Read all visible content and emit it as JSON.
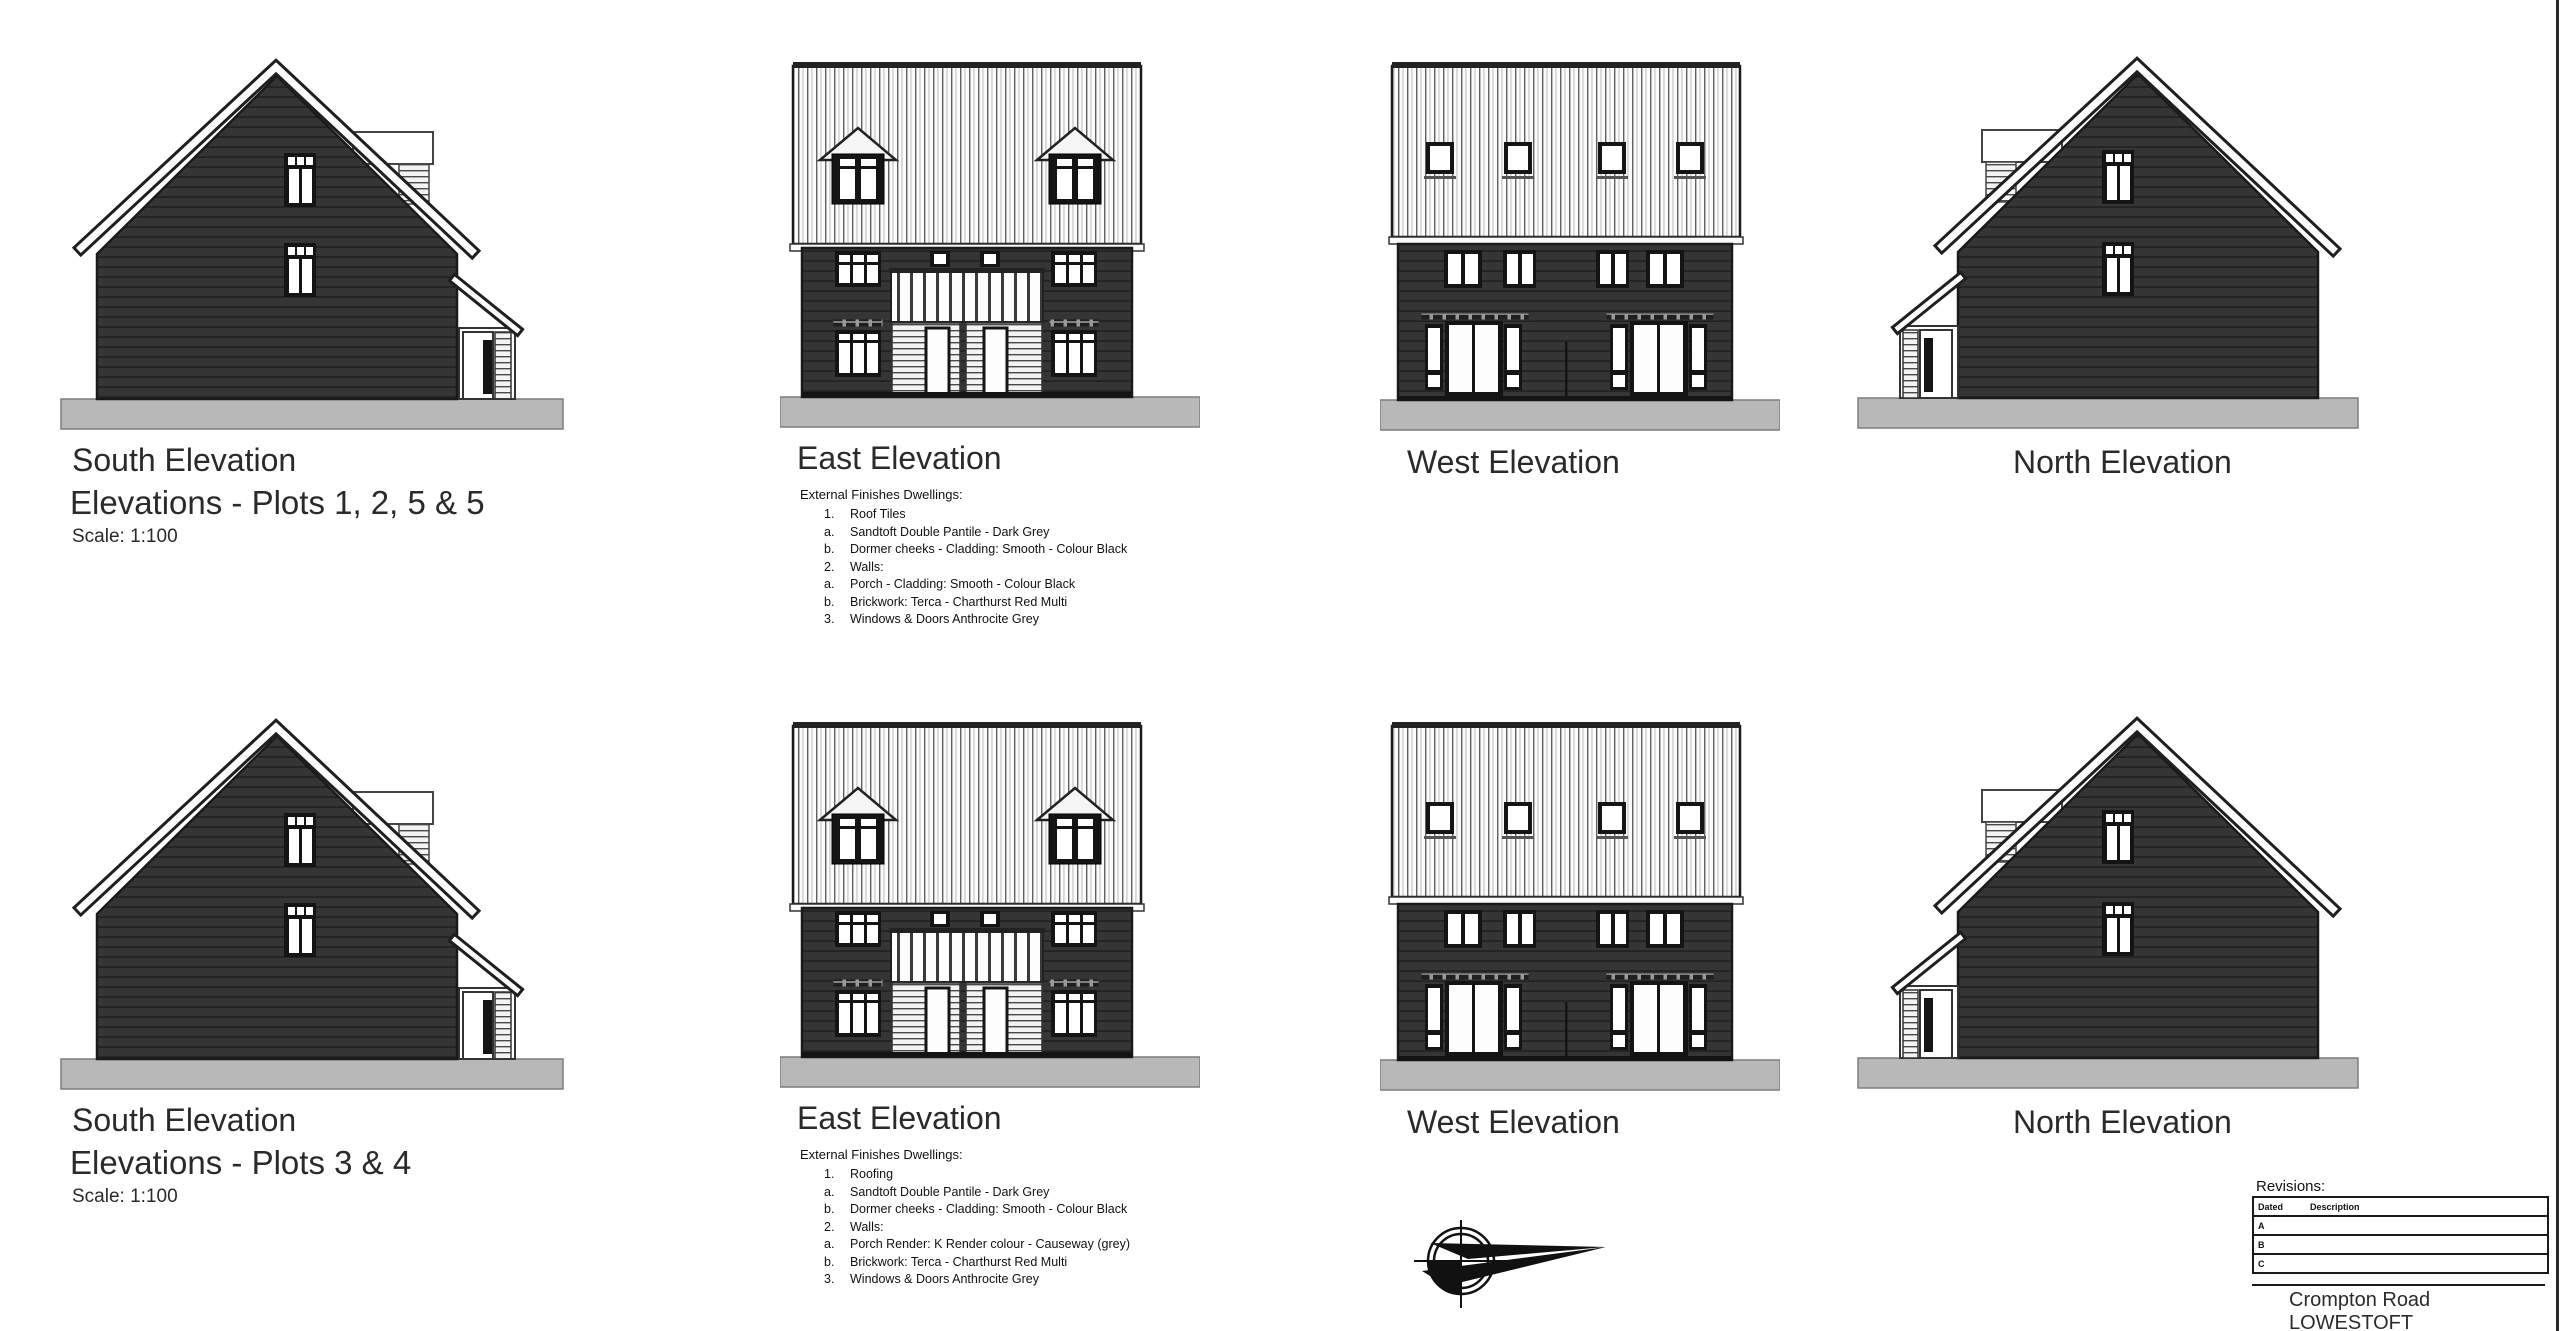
{
  "sheet": {
    "background": "#ffffff"
  },
  "colors": {
    "wall_cladding_dark": "#353535",
    "roof_tile_white": "#fbfbfb",
    "outline": "#1a1a1a",
    "ground_grey": "#b8b8b8"
  },
  "rows": [
    {
      "south": {
        "title": "South Elevation",
        "subtitle": "Elevations - Plots 1, 2, 5 & 5",
        "scale": "Scale: 1:100"
      },
      "east": {
        "title": "East Elevation",
        "notes_heading": "External Finishes Dwellings:",
        "notes": [
          {
            "num": "1.",
            "text": "Roof Tiles"
          },
          {
            "num": "a.",
            "text": "Sandtoft Double Pantile - Dark Grey"
          },
          {
            "num": "b.",
            "text": "Dormer cheeks - Cladding: Smooth - Colour Black"
          },
          {
            "num": "2.",
            "text": "Walls:"
          },
          {
            "num": "a.",
            "text": "Porch - Cladding: Smooth - Colour Black"
          },
          {
            "num": "b.",
            "text": "Brickwork:  Terca - Charthurst Red Multi"
          },
          {
            "num": "3.",
            "text": "Windows & Doors Anthrocite Grey"
          }
        ]
      },
      "west": {
        "title": "West Elevation"
      },
      "north": {
        "title": "North Elevation"
      }
    },
    {
      "south": {
        "title": "South Elevation",
        "subtitle": "Elevations - Plots 3 & 4",
        "scale": "Scale: 1:100"
      },
      "east": {
        "title": "East Elevation",
        "notes_heading": "External Finishes Dwellings:",
        "notes": [
          {
            "num": "1.",
            "text": "Roofing"
          },
          {
            "num": "a.",
            "text": "Sandtoft Double Pantile - Dark Grey"
          },
          {
            "num": "b.",
            "text": "Dormer cheeks - Cladding: Smooth - Colour Black"
          },
          {
            "num": "2.",
            "text": "Walls:"
          },
          {
            "num": "a.",
            "text": "Porch Render: K Render colour - Causeway (grey)"
          },
          {
            "num": "b.",
            "text": "Brickwork:  Terca - Charthurst Red Multi"
          },
          {
            "num": "3.",
            "text": "Windows & Doors Anthrocite Grey"
          }
        ]
      },
      "west": {
        "title": "West Elevation"
      },
      "north": {
        "title": "North Elevation"
      }
    }
  ],
  "title_block": {
    "revisions_label": "Revisions:",
    "table": {
      "columns": [
        "Dated",
        "Description"
      ],
      "rows": [
        "A",
        "B",
        "C"
      ]
    },
    "project_line1": "Crompton Road",
    "project_line2": "LOWESTOFT"
  },
  "icons": {
    "compass": "north-arrow-compass"
  }
}
